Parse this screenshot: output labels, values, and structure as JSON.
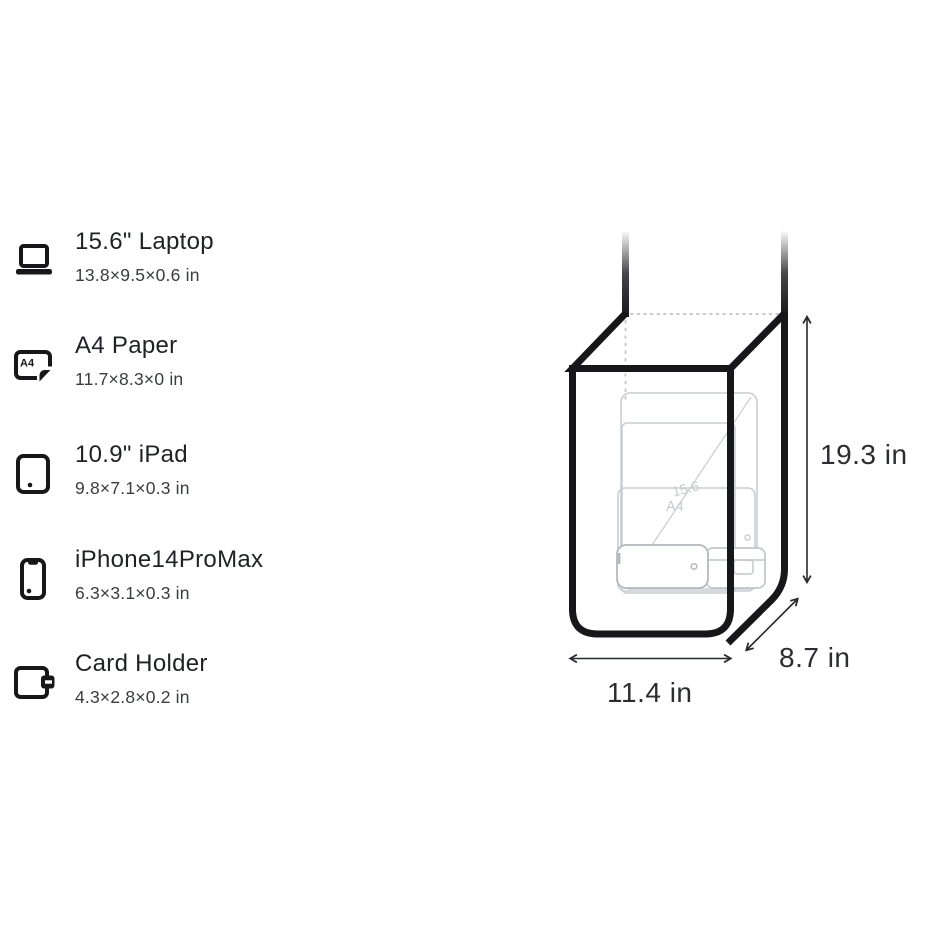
{
  "items": [
    {
      "name": "15.6\" Laptop",
      "dimensions": "13.8×9.5×0.6 in",
      "icon": "laptop-icon"
    },
    {
      "name": "A4 Paper",
      "dimensions": "11.7×8.3×0 in",
      "icon": "a4-paper-icon"
    },
    {
      "name": "10.9\" iPad",
      "dimensions": "9.8×7.1×0.3 in",
      "icon": "ipad-icon"
    },
    {
      "name": "iPhone14ProMax",
      "dimensions": "6.3×3.1×0.3 in",
      "icon": "iphone-icon"
    },
    {
      "name": "Card Holder",
      "dimensions": "4.3×2.8×0.2 in",
      "icon": "card-holder-icon"
    }
  ],
  "icons": {
    "a4_icon_label": "A4"
  },
  "diagram": {
    "height_label": "19.3 in",
    "width_label": "11.4 in",
    "depth_label": "8.7 in",
    "ghost_laptop_label": "15.6",
    "ghost_a4_label": "A4",
    "colors": {
      "outline": "#17171a",
      "ghost": "#c9cdd2",
      "ghost_front": "#b4b8bd",
      "arrow": "#26282c",
      "label_text": "#2b2d31"
    }
  }
}
